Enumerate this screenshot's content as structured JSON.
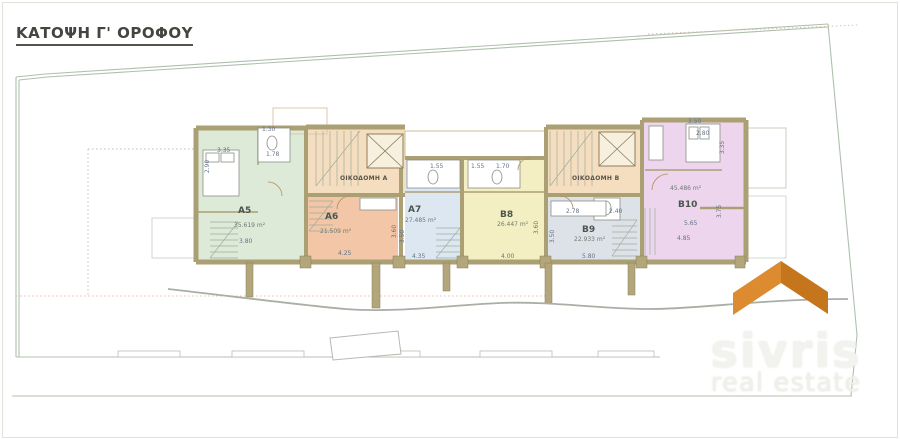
{
  "title": "ΚΑΤΟΨΗ Γ' ΟΡΟΦΟΥ",
  "buildings": {
    "a": "ΟΙΚΟΔΟΜΗ Α",
    "b": "ΟΙΚΟΔΟΜΗ Β"
  },
  "units": {
    "a5": {
      "label": "A5",
      "area": "35.619 m²",
      "color": "#dcead7"
    },
    "a6": {
      "label": "A6",
      "area": "21.509 m²",
      "color": "#f2c6a6"
    },
    "a7": {
      "label": "A7",
      "area": "27.485 m²",
      "color": "#dce7f2"
    },
    "b8": {
      "label": "B8",
      "area": "26.447 m²",
      "color": "#f4efc3"
    },
    "b9": {
      "label": "B9",
      "area": "22.933 m²",
      "color": "#dde2e8"
    },
    "b10": {
      "label": "B10",
      "area": "45.486 m²",
      "color": "#ecd5ed"
    }
  },
  "dims": {
    "a5_balcony": "1.30",
    "a5_top": "3.35",
    "a5_bath": "1.78",
    "a5_left": "2.90",
    "a5_bottom": "3.80",
    "a6_bottom": "4.25",
    "a6_right": "3.60",
    "a7_top": "1.55",
    "a7_left": "3.50",
    "a7_bottom": "4.35",
    "b8_top1": "1.55",
    "b8_top2": "1.70",
    "b8_bottom": "4.00",
    "b8_right": "3.60",
    "b9_top1": "2.78",
    "b9_top2": "2.40",
    "b9_left": "3.50",
    "b9_bottom": "5.80",
    "b10_top1": "3.50",
    "b10_top2": "2.80",
    "b10_right1": "3.35",
    "b10_mid": "5.65",
    "b10_bottom": "4.85",
    "b10_right2": "3.75"
  },
  "logo": {
    "brand": "sivris",
    "tagline": "real estate",
    "roof_color_left": "#dd8b31",
    "roof_color_right": "#c5761c"
  }
}
